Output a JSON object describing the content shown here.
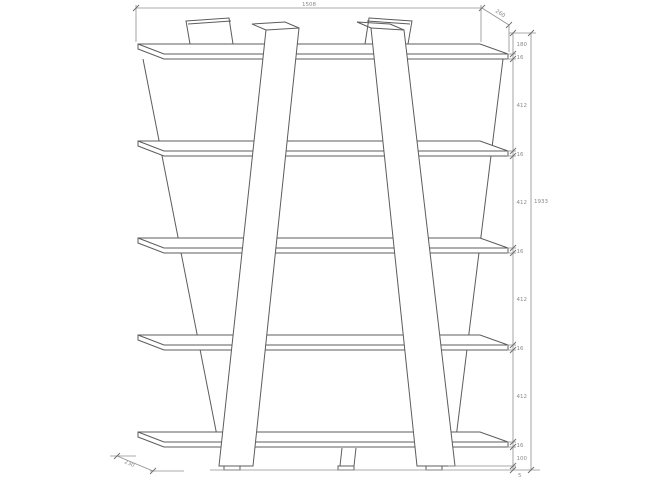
{
  "drawing": {
    "description": "Front elevation technical drawing of a five-shelf ladder-style bookcase with slanted V-frame legs and dimension chains",
    "dimensions": {
      "width_top": "1508",
      "depth_top": "260",
      "depth_bottom": "230",
      "height_overall": "1933",
      "height_chain": [
        "180",
        "16",
        "412",
        "16",
        "412",
        "16",
        "412",
        "16",
        "412",
        "16",
        "100",
        "5"
      ]
    }
  }
}
